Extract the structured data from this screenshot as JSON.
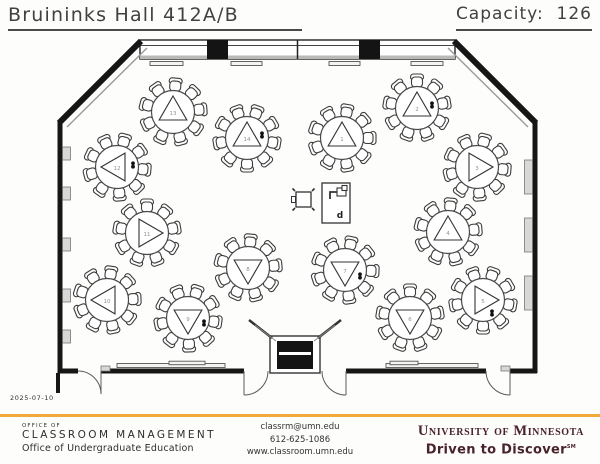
{
  "header": {
    "title": "Bruininks Hall 412A/B",
    "capacity_label": "Capacity:",
    "capacity_value": "126"
  },
  "plan": {
    "date": "2025-07-10",
    "chairs_per_table": 9,
    "table_radius": 21.5,
    "chair_orbit": 27,
    "station": {
      "podium_text": "d"
    },
    "tables": [
      {
        "number": "1",
        "x": 342,
        "y": 138,
        "triangle_deg": 0,
        "start_deg": 10,
        "power": false,
        "power_dx": 0,
        "power_dy": 0
      },
      {
        "number": "2",
        "x": 417,
        "y": 108,
        "triangle_deg": 0,
        "start_deg": 0,
        "power": true,
        "power_dx": 15,
        "power_dy": -3
      },
      {
        "number": "3",
        "x": 477,
        "y": 167,
        "triangle_deg": 90,
        "start_deg": 15,
        "power": false,
        "power_dx": 0,
        "power_dy": 0
      },
      {
        "number": "4",
        "x": 448,
        "y": 232,
        "triangle_deg": 0,
        "start_deg": 5,
        "power": false,
        "power_dx": 0,
        "power_dy": 0
      },
      {
        "number": "5",
        "x": 483,
        "y": 300,
        "triangle_deg": 90,
        "start_deg": 20,
        "power": true,
        "power_dx": 9,
        "power_dy": 13
      },
      {
        "number": "6",
        "x": 410,
        "y": 318,
        "triangle_deg": 180,
        "start_deg": 0,
        "power": false,
        "power_dx": 0,
        "power_dy": 0
      },
      {
        "number": "7",
        "x": 345,
        "y": 270,
        "triangle_deg": 180,
        "start_deg": 12,
        "power": true,
        "power_dx": 15,
        "power_dy": 6
      },
      {
        "number": "8",
        "x": 248,
        "y": 268,
        "triangle_deg": 180,
        "start_deg": 5,
        "power": false,
        "power_dx": 0,
        "power_dy": 0
      },
      {
        "number": "9",
        "x": 188,
        "y": 318,
        "triangle_deg": 180,
        "start_deg": 18,
        "power": true,
        "power_dx": 16,
        "power_dy": 5
      },
      {
        "number": "10",
        "x": 107,
        "y": 300,
        "triangle_deg": 270,
        "start_deg": 8,
        "power": false,
        "power_dx": 0,
        "power_dy": 0
      },
      {
        "number": "11",
        "x": 147,
        "y": 233,
        "triangle_deg": 90,
        "start_deg": 0,
        "power": false,
        "power_dx": 0,
        "power_dy": 0
      },
      {
        "number": "12",
        "x": 117,
        "y": 167,
        "triangle_deg": 270,
        "start_deg": 15,
        "power": true,
        "power_dx": 16,
        "power_dy": -2
      },
      {
        "number": "13",
        "x": 173,
        "y": 112,
        "triangle_deg": 0,
        "start_deg": 5,
        "power": false,
        "power_dx": 0,
        "power_dy": 0
      },
      {
        "number": "14",
        "x": 247,
        "y": 138,
        "triangle_deg": 0,
        "start_deg": 20,
        "power": true,
        "power_dx": 15,
        "power_dy": -3
      }
    ]
  },
  "footer": {
    "left": [
      "OFFICE OF",
      "CLASSROOM MANAGEMENT",
      "Office of Undergraduate Education"
    ],
    "center": [
      "classrm@umn.edu",
      "612-625-1086",
      "www.classroom.umn.edu"
    ],
    "right": {
      "wordmark": "University of Minnesota",
      "tagline": "Driven to Discover",
      "tagline_sup": "SM"
    }
  },
  "colors": {
    "gold": "#F2A93C",
    "maroon": "#49232B",
    "ink": "#333333"
  }
}
